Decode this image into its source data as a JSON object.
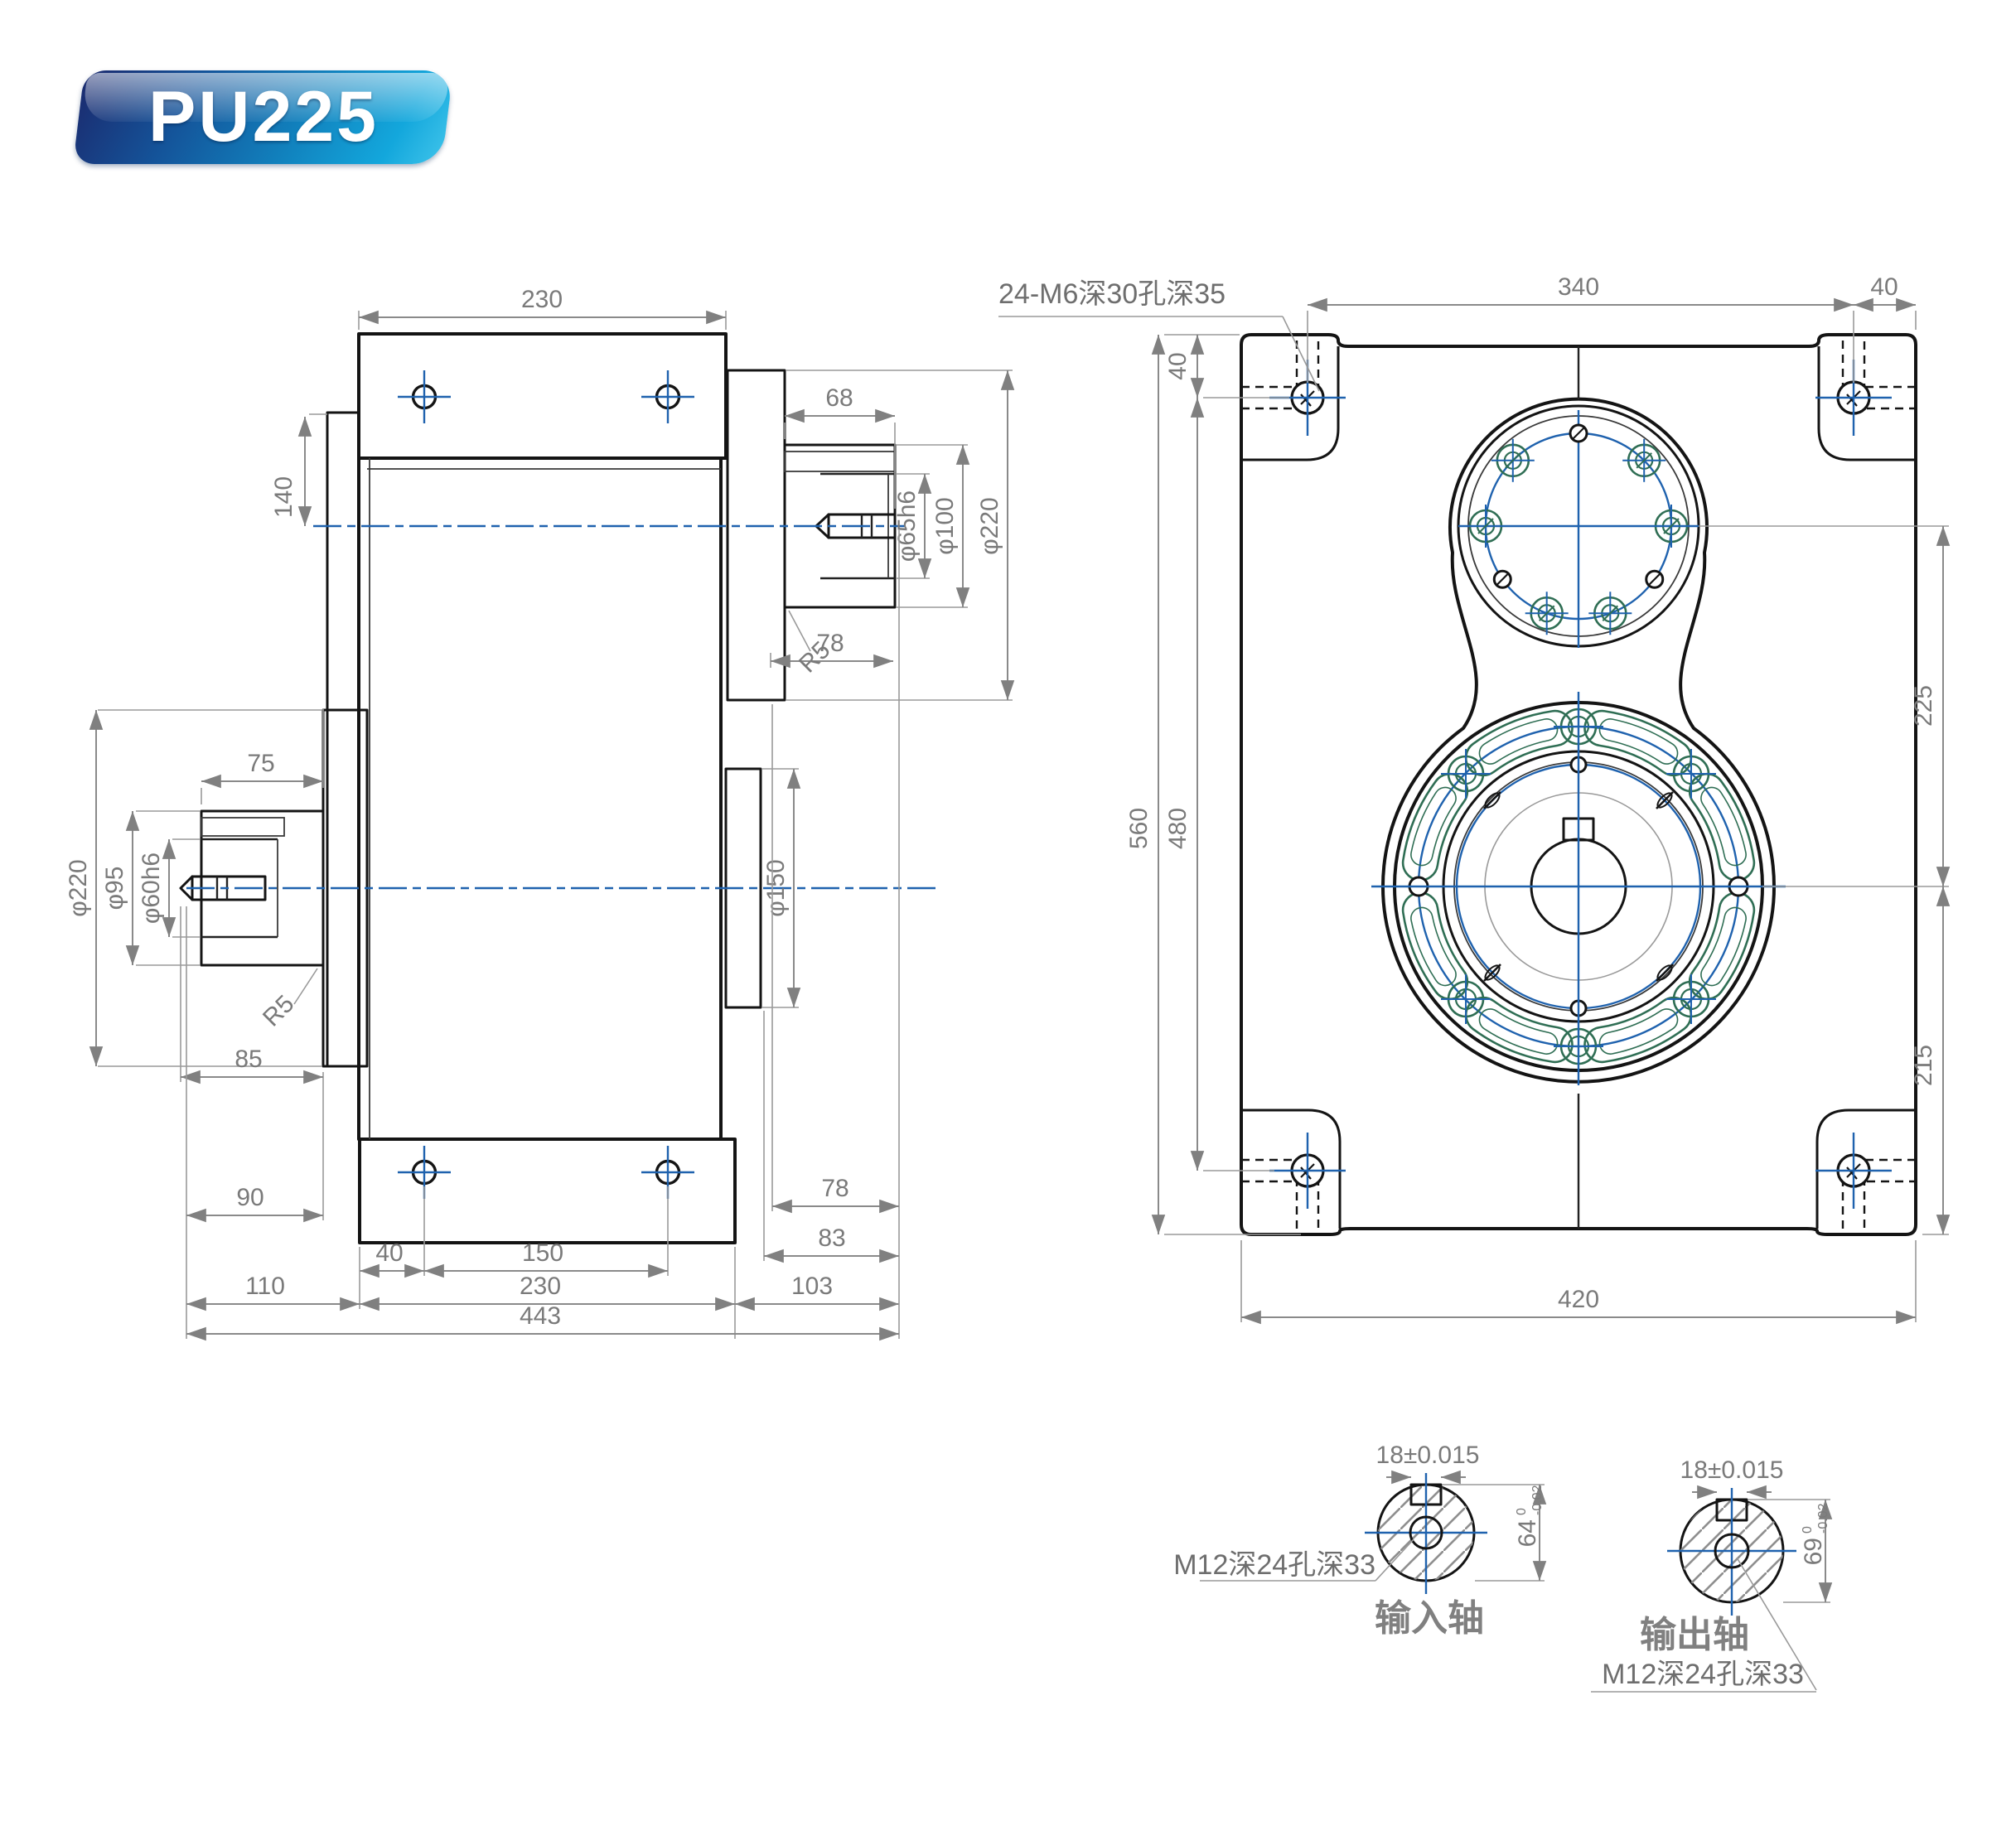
{
  "badge": {
    "label": "PU225"
  },
  "front_view": {
    "note": "24-M6深30孔深35",
    "dim_340": "340",
    "dim_40_top_right": "40",
    "dim_40_left": "40",
    "dim_560": "560",
    "dim_480": "480",
    "dim_225": "225",
    "dim_215": "215",
    "dim_420": "420"
  },
  "side_view": {
    "dim_230_top": "230",
    "dim_140": "140",
    "dim_68": "68",
    "dia_65": "φ65h6",
    "dia_100": "φ100",
    "dia_220_input": "φ220",
    "fillet_input": "R5",
    "dim_78_input": "78",
    "dim_75": "75",
    "dia_220_output": "φ220",
    "dia_95": "φ95",
    "dia_60": "φ60h6",
    "fillet_output": "R5",
    "dim_85": "85",
    "dia_150": "φ150",
    "dim_90": "90",
    "dim_40_bottom": "40",
    "dim_150_bottom": "150",
    "dim_110": "110",
    "dim_230_bottom": "230",
    "dim_103": "103",
    "dim_443": "443",
    "dim_78_bottom": "78",
    "dim_83": "83"
  },
  "input_detail": {
    "title": "输入轴",
    "keyway": "18±0.015",
    "dia": "64",
    "tol_upper": "0",
    "tol_lower": "-0.02",
    "thread": "M12深24孔深33"
  },
  "output_detail": {
    "title": "输出轴",
    "keyway": "18±0.015",
    "dia": "69",
    "tol_upper": "0",
    "tol_lower": "-0.02",
    "thread": "M12深24孔深33"
  }
}
